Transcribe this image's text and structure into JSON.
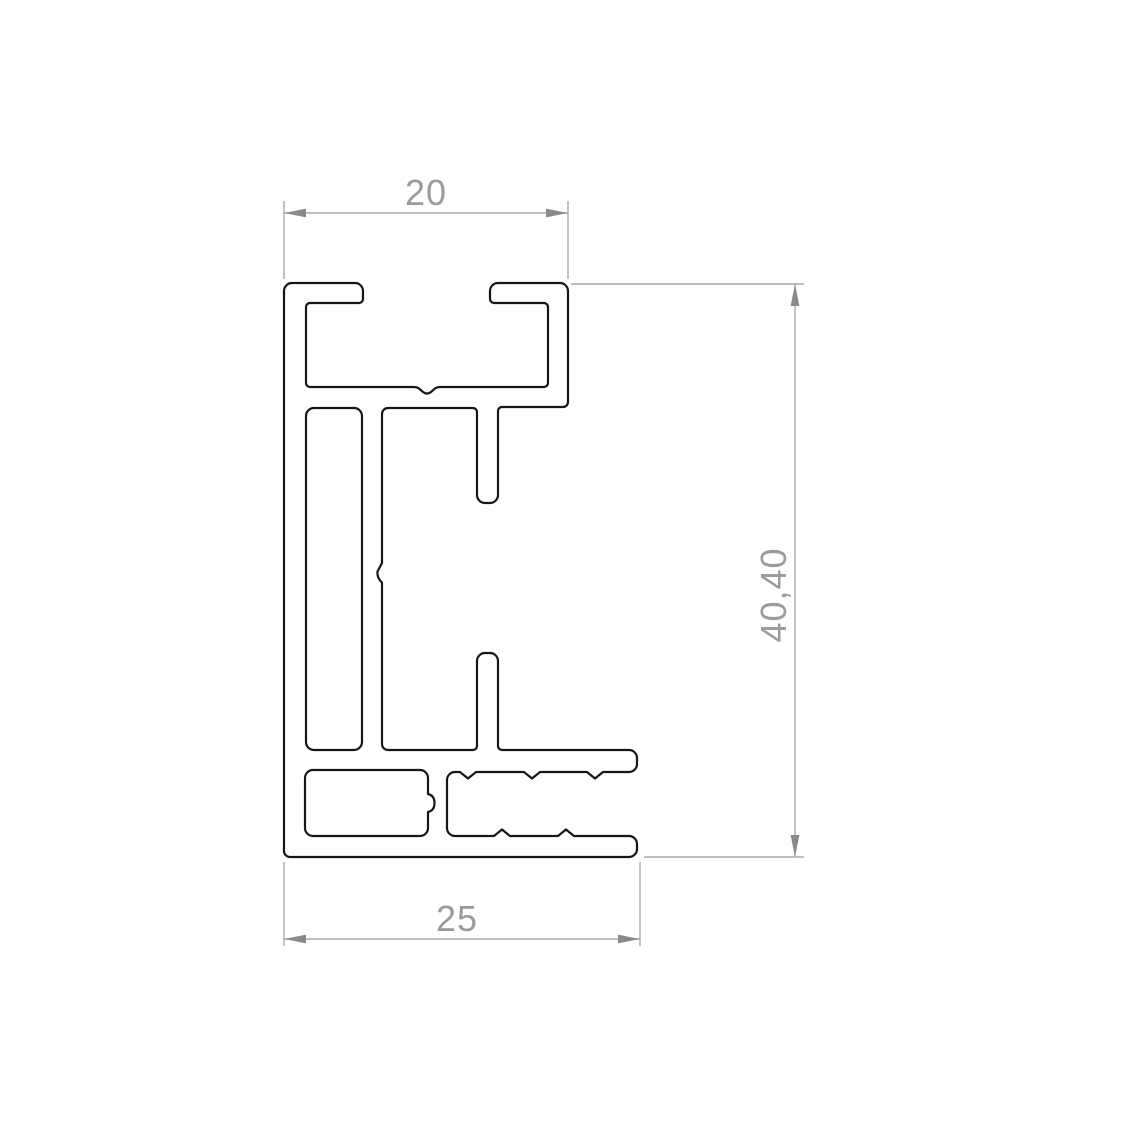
{
  "page": {
    "background": "#ffffff",
    "description": "Technical cross-section drawing of an aluminum extrusion profile with three dimensions"
  },
  "drawing": {
    "outline_color": "#161616",
    "dimension_line_color": "#a8a8a8",
    "dimension_arrow_color": "#8a8a8a",
    "dimension_text_color": "#9b9b9b",
    "dimensions": {
      "top_width": {
        "label": "20",
        "orientation": "horizontal",
        "position": "top"
      },
      "bottom_width": {
        "label": "25",
        "orientation": "horizontal",
        "position": "bottom"
      },
      "overall_height": {
        "label": "40,40",
        "orientation": "vertical",
        "position": "right"
      }
    }
  }
}
